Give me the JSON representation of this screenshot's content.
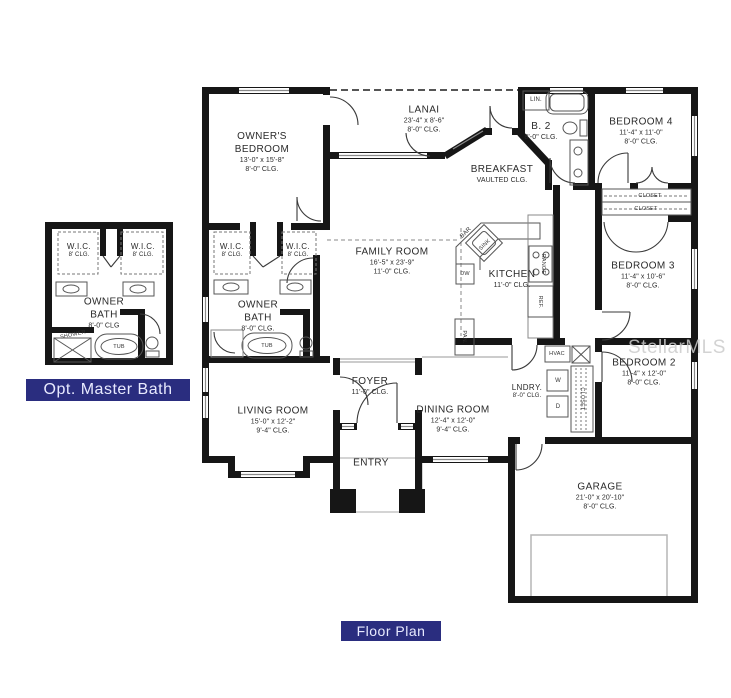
{
  "captions": {
    "opt_master_bath": "Opt. Master Bath",
    "floor_plan": "Floor Plan"
  },
  "watermark": "StellarMLS",
  "colors": {
    "caption_bg": "#2a2d7f",
    "caption_text": "#e8eaff",
    "wall": "#161616",
    "watermark_gray": "#cccccc"
  },
  "rooms": {
    "owners_bedroom": {
      "name": "OWNER'S BEDROOM",
      "dims": "13'-0\" x 15'-8\"",
      "clg": "8'-0\" CLG."
    },
    "lanai": {
      "name": "LANAI",
      "dims": "23'-4\" x 8'-6\"",
      "clg": "8'-0\" CLG."
    },
    "bath2": {
      "name": "B. 2",
      "clg": "8'-0\" CLG."
    },
    "bedroom4": {
      "name": "BEDROOM 4",
      "dims": "11'-4\" x 11'-0\"",
      "clg": "8'-0\" CLG."
    },
    "breakfast": {
      "name": "BREAKFAST",
      "clg": "VAULTED CLG."
    },
    "family_room": {
      "name": "FAMILY ROOM",
      "dims": "16'-5\" x 23'-9\"",
      "clg": "11'-0\" CLG."
    },
    "kitchen": {
      "name": "KITCHEN",
      "clg": "11'-0\" CLG."
    },
    "bedroom3": {
      "name": "BEDROOM 3",
      "dims": "11'-4\" x 10'-6\"",
      "clg": "8'-0\" CLG."
    },
    "bedroom2": {
      "name": "BEDROOM 2",
      "dims": "11'-4\" x 12'-0\"",
      "clg": "8'-0\" CLG."
    },
    "laundry": {
      "name": "LNDRY.",
      "clg": "8'-0\" CLG."
    },
    "living_room": {
      "name": "LIVING ROOM",
      "dims": "15'-0\" x 12'-2\"",
      "clg": "9'-4\" CLG."
    },
    "foyer": {
      "name": "FOYER",
      "clg": "11'-0\" CLG."
    },
    "dining_room": {
      "name": "DINING ROOM",
      "dims": "12'-4\" x 12'-0\"",
      "clg": "9'-4\" CLG."
    },
    "entry": {
      "name": "ENTRY"
    },
    "garage": {
      "name": "GARAGE",
      "dims": "21'-0\" x 20'-10\"",
      "clg": "8'-0\" CLG."
    },
    "owner_bath_main": {
      "name": "OWNER BATH",
      "clg": "8'-0\" CLG."
    },
    "owner_bath_opt": {
      "name": "OWNER BATH",
      "clg": "8'-0\" CLG"
    },
    "wic_main_left": {
      "name": "W.I.C.",
      "clg": "8' CLG."
    },
    "wic_main_right": {
      "name": "W.I.C.",
      "clg": "8' CLG."
    },
    "wic_opt_left": {
      "name": "W.I.C.",
      "clg": "8' CLG."
    },
    "wic_opt_right": {
      "name": "W.I.C.",
      "clg": "8' CLG."
    }
  },
  "fixtures": {
    "lin": "LIN.",
    "bar": "BAR",
    "sink": "SINK",
    "dw": "DW",
    "range": "RANGE",
    "ref": "REF.",
    "pantry": "PAN.",
    "hvac": "HVAC",
    "washer": "W",
    "dryer": "D",
    "closet_vertical": "CLOSET",
    "closet_top": "CLOSET",
    "closet_bottom": "CLOSET",
    "tub_main": "TUB",
    "tub_opt": "TUB",
    "shower_opt": "SHOWER"
  }
}
